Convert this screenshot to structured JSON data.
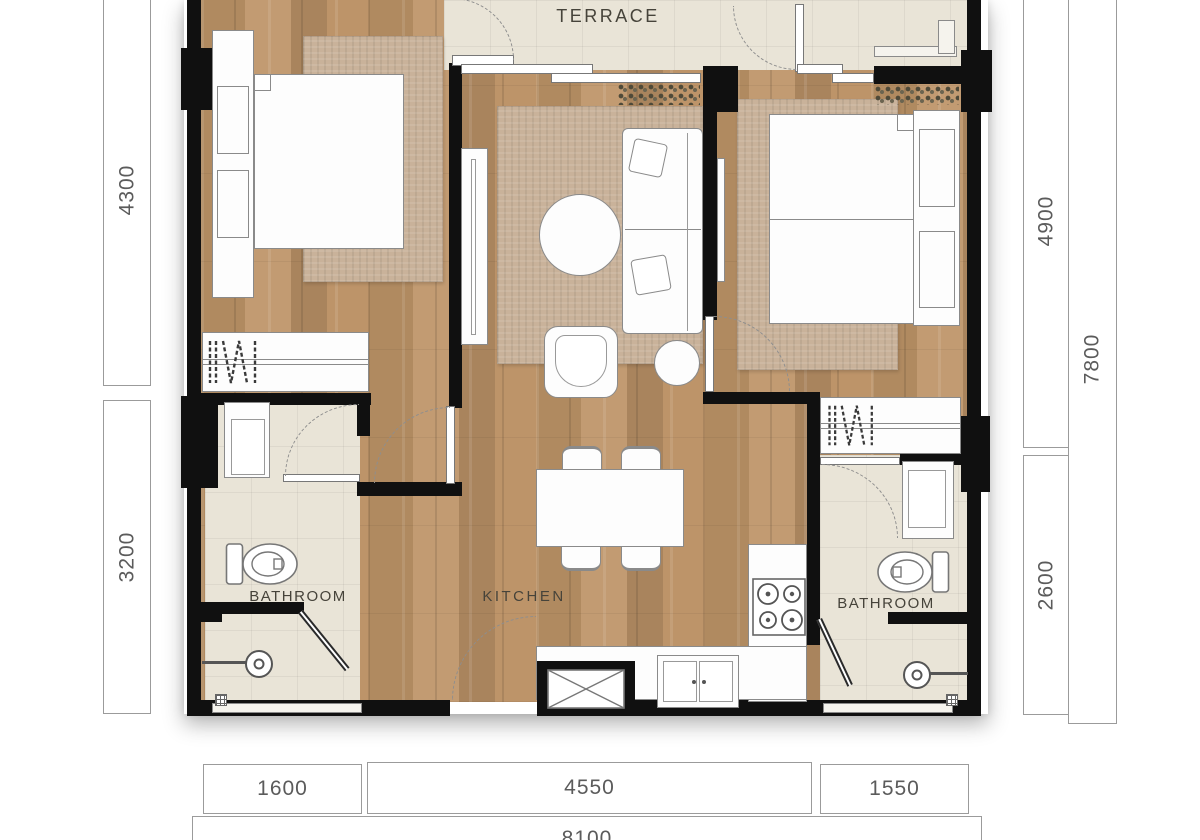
{
  "page": {
    "type": "apartment-floor-plan"
  },
  "rooms": {
    "terrace": {
      "label": "TERRACE"
    },
    "kitchen": {
      "label": "KITCHEN"
    },
    "bathroom_left": {
      "label": "BATHROOM"
    },
    "bathroom_right": {
      "label": "BATHROOM"
    }
  },
  "dimensions_mm": {
    "left_top": "4300",
    "left_bottom": "3200",
    "right_top": "4900",
    "right_total": "7800",
    "right_bottom": "2600",
    "bottom_left": "1600",
    "bottom_center": "4550",
    "bottom_right": "1550",
    "bottom_total": "8100"
  },
  "colors": {
    "wall": "#101010",
    "wood_floor": "#b7906a",
    "tile_floor": "#e9e4d7",
    "rug": "#c9b29a",
    "furniture": "#ffffff",
    "dimension_text": "#5b5b5b"
  }
}
